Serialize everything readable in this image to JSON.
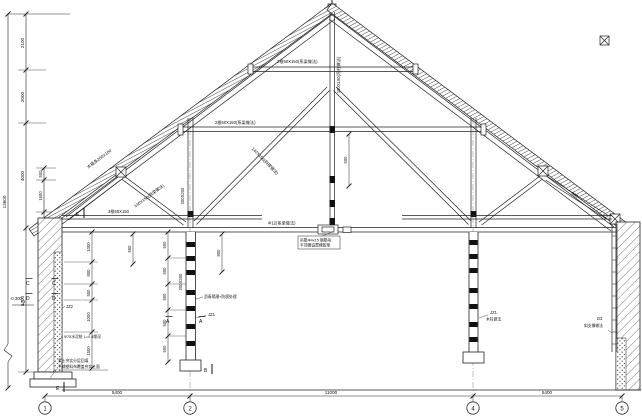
{
  "labels": {
    "purlin": "木檩条200X100",
    "rafter": "140X150(斜梁做法)",
    "strut": "140X150(斜撑做法)",
    "collar_upper": "2根50X150(系梁做法)",
    "collar_mid": "2根50X150(系梁做法)",
    "beam_left": "3根50X150",
    "king_post": "150X150(吊柱做法)",
    "queen_post": "200X200",
    "column_mid": "200X200",
    "tie_rod": "Φ12(系梁做法)",
    "hanger_note_1": "吊筋Φ4x15 钢筋吊",
    "hanger_note_2": "平顶棚设置橡胶垫",
    "column_note": "沥青隔潮+防腐处理",
    "pile_note": "Φ75水泥桩 L=0.8埋深",
    "ground_note_1": "素土夯实分层回填",
    "ground_note_2": "平铺塑料布覆盖夯实土面",
    "jz2": "JZ2",
    "jz1": "JZ1",
    "jz1_right": "JZ1",
    "wood_column_note": "木柱做法",
    "d3": "D3",
    "d3_note": "斜支撑做法",
    "level": "-0.300"
  },
  "dims": {
    "total_height": "13600",
    "h1": "2100",
    "h2": "2000",
    "h3": "4000",
    "h4": "5700",
    "s1": "500",
    "s2": "1600",
    "s3": "910",
    "span1": "5400",
    "span2": "11000",
    "span3": "5400",
    "seg500": "500",
    "w1": "1000",
    "w2": "800",
    "w3": "500",
    "w4": "1000",
    "w5": "1500",
    "d550": "550",
    "d800": "800",
    "d600": "600",
    "d900": "900"
  },
  "marks": {
    "a": "A",
    "b": "B",
    "c": "C",
    "d": "D",
    "e": "E"
  },
  "axis_bubbles": {
    "b1": "1",
    "b2": "2",
    "b3": "4",
    "b4": "5"
  }
}
